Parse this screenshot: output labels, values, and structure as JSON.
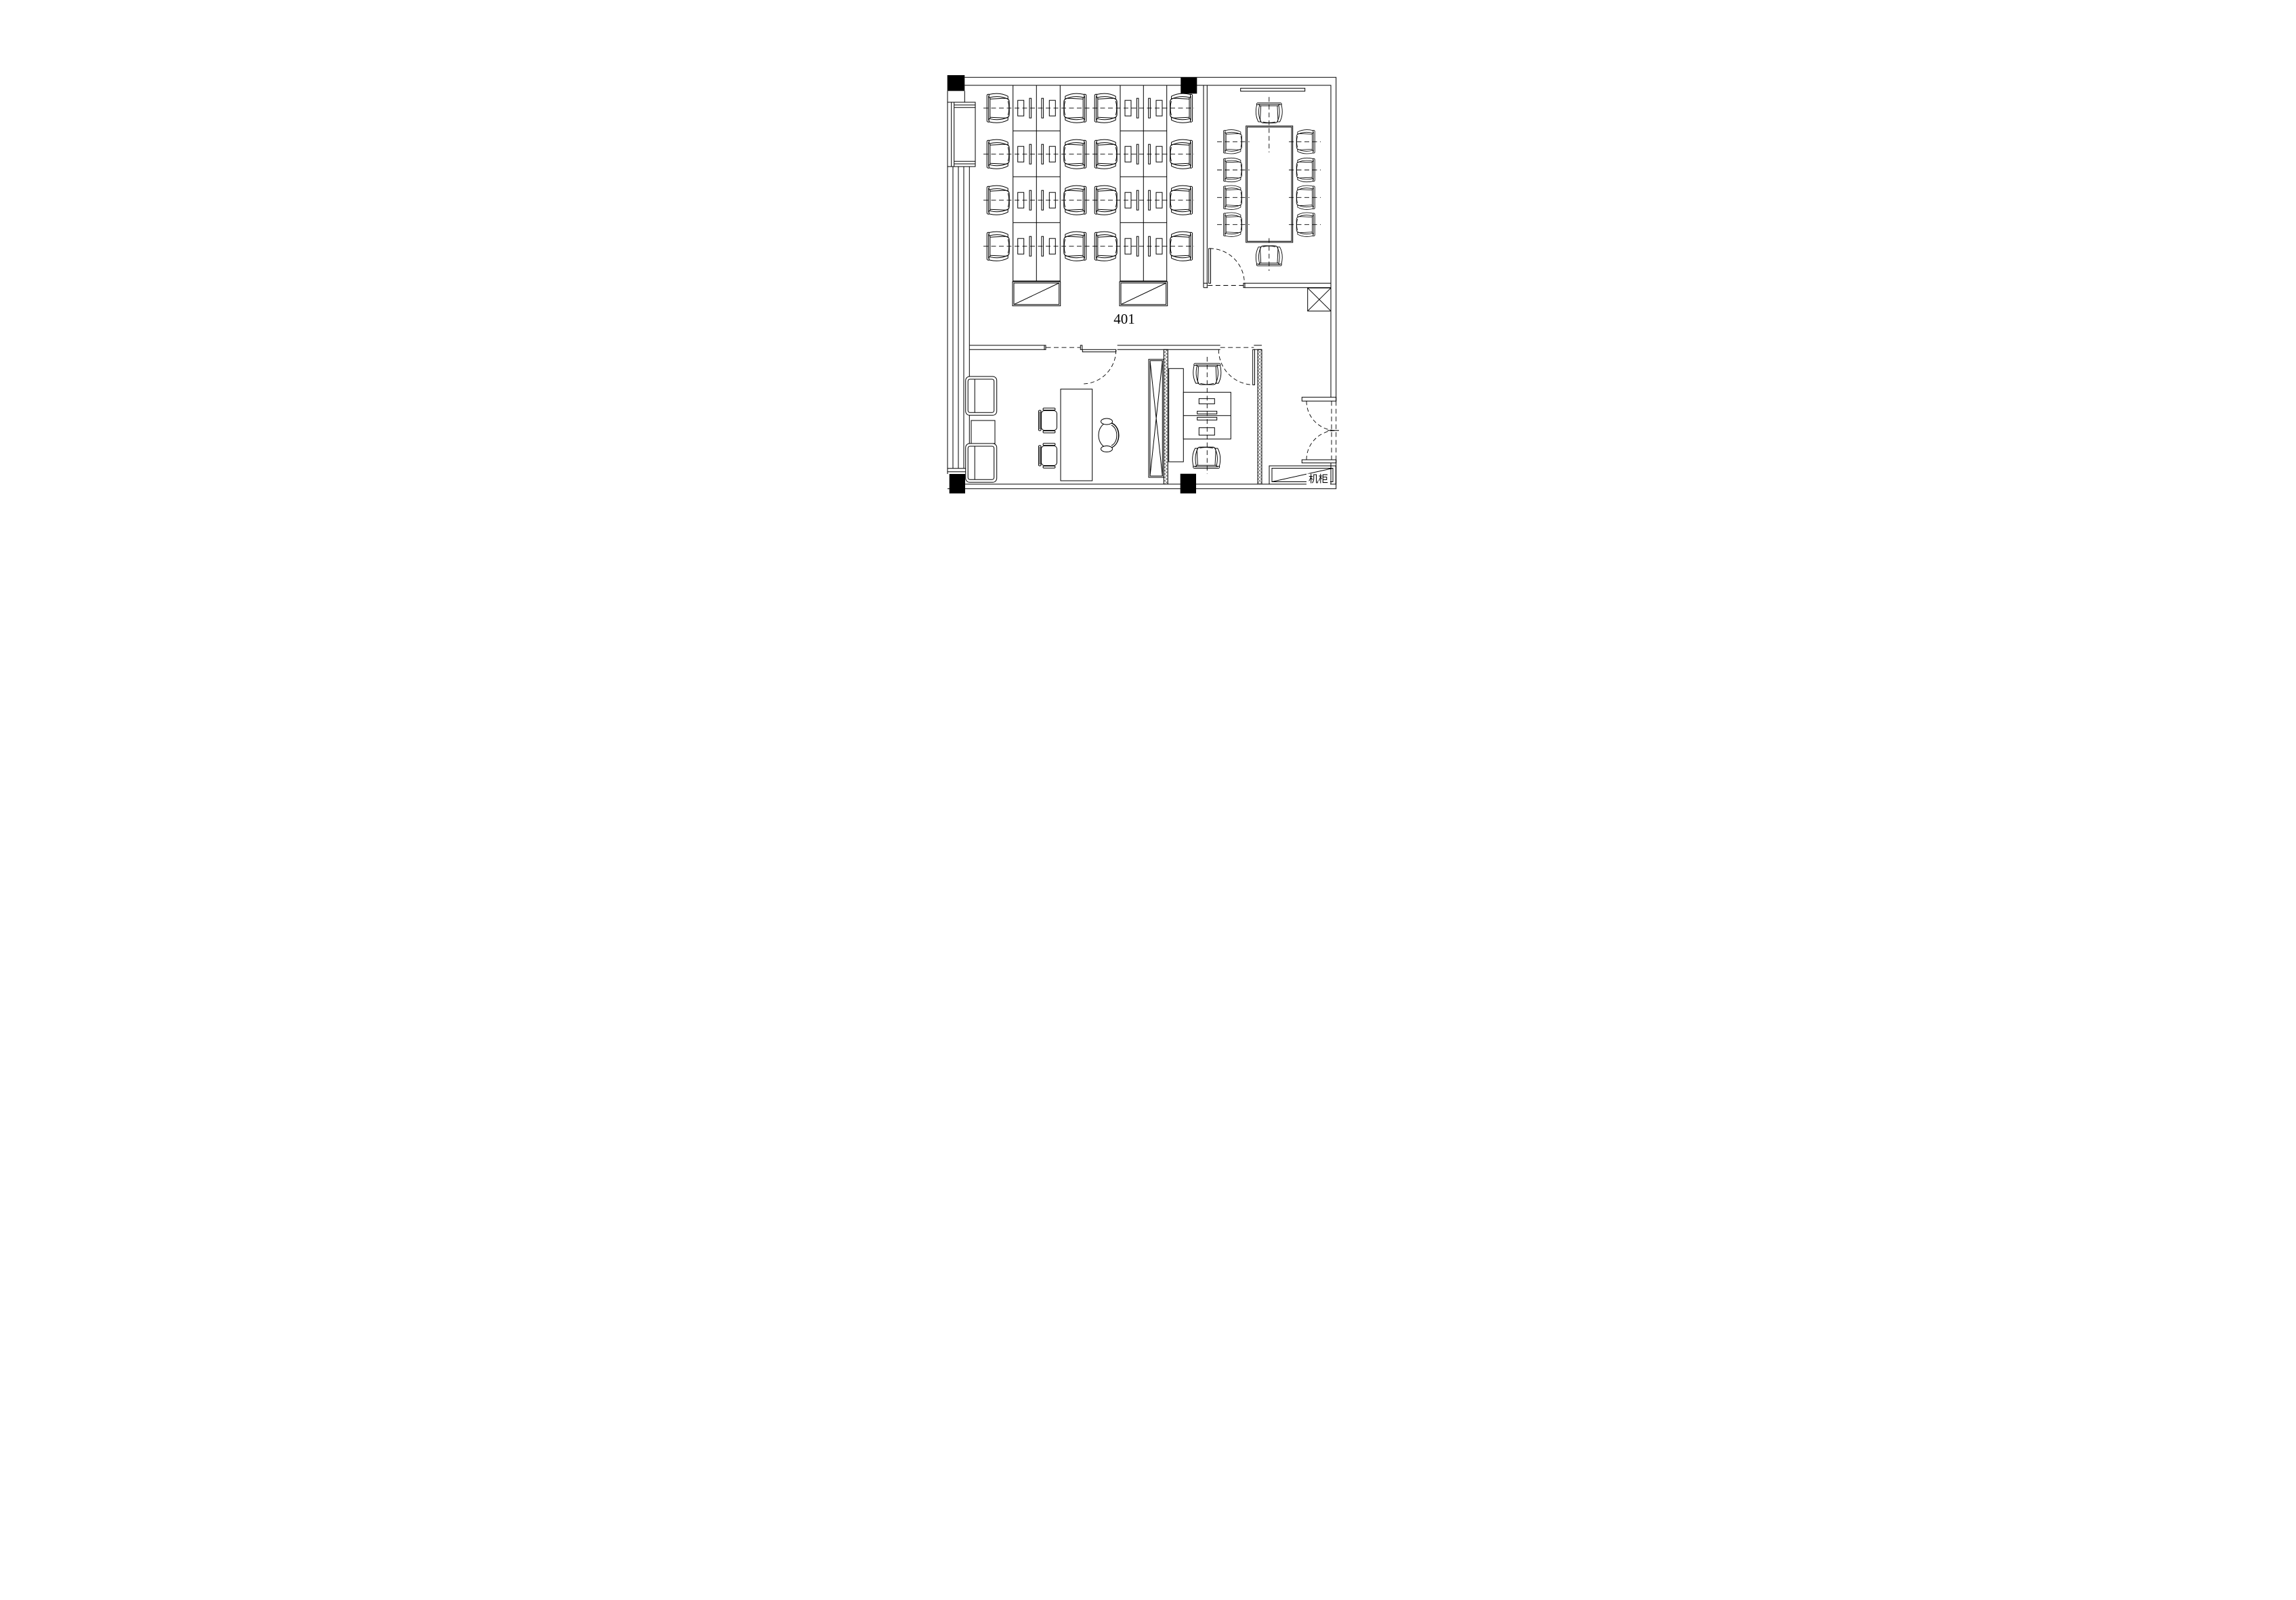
{
  "drawing": {
    "room_number_label": "401",
    "equipment_cabinet_label": "机柜"
  },
  "colors": {
    "line": "#000000",
    "background": "#ffffff",
    "column_fill": "#000000",
    "hatch_wall": "#444444"
  }
}
